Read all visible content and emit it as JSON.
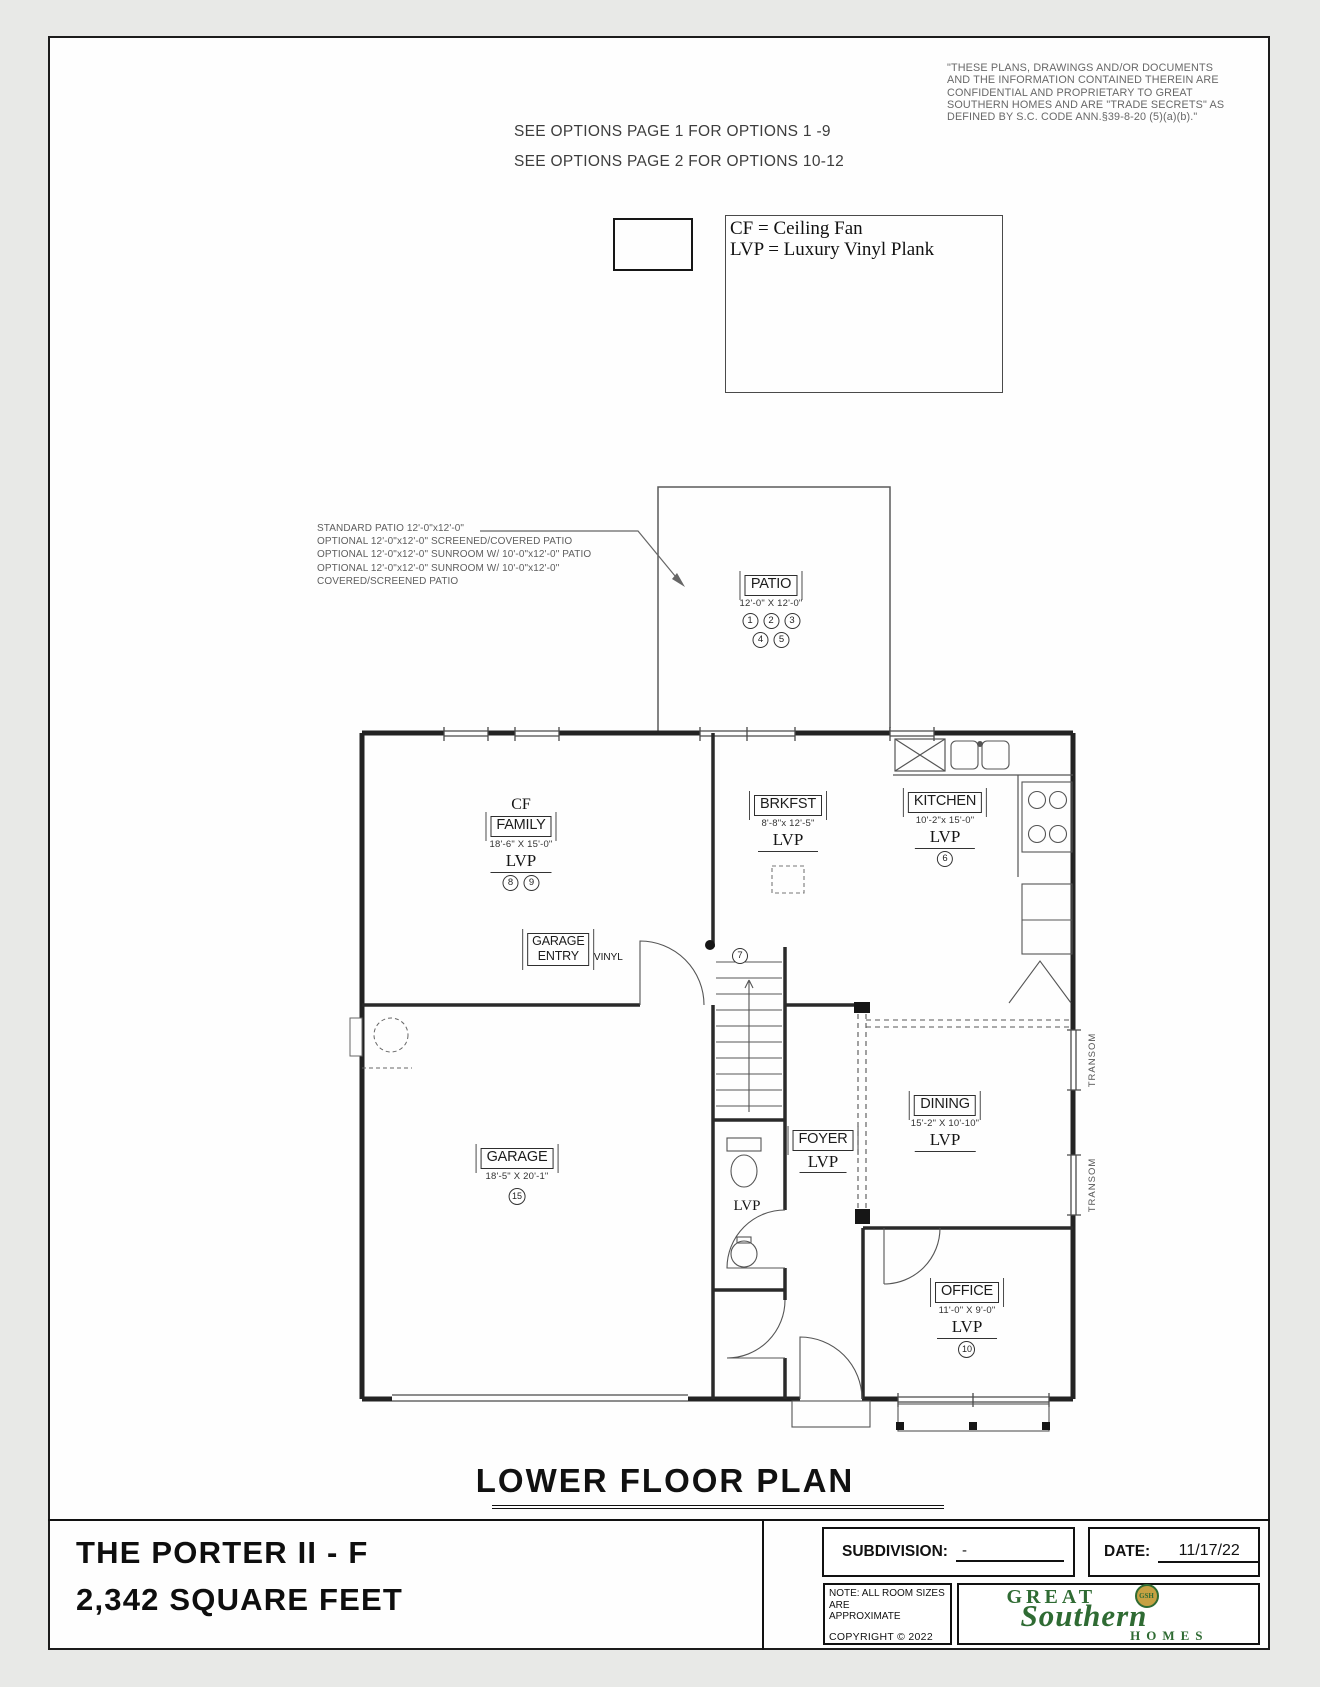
{
  "header": {
    "disclaimer_lines": [
      "\"THESE PLANS, DRAWINGS AND/OR DOCUMENTS",
      "AND THE INFORMATION CONTAINED THEREIN ARE",
      "CONFIDENTIAL AND PROPRIETARY TO  GREAT",
      "SOUTHERN HOMES AND ARE \"TRADE SECRETS\" AS",
      "DEFINED BY S.C. CODE ANN.§39-8-20 (5)(a)(b).\""
    ],
    "options_lines": [
      "SEE OPTIONS PAGE 1 FOR OPTIONS 1 -9",
      "SEE OPTIONS PAGE 2 FOR OPTIONS 10-12"
    ]
  },
  "legend": {
    "lines": [
      "CF = Ceiling Fan",
      "LVP = Luxury Vinyl Plank"
    ]
  },
  "patio_notes": [
    "STANDARD PATIO 12'-0\"x12'-0\"",
    "OPTIONAL 12'-0\"x12'-0\" SCREENED/COVERED PATIO",
    "OPTIONAL 12'-0\"x12'-0\" SUNROOM W/ 10'-0\"x12'-0\" PATIO",
    "OPTIONAL 12'-0\"x12'-0\" SUNROOM W/ 10'-0\"x12'-0\"",
    "COVERED/SCREENED PATIO"
  ],
  "rooms": {
    "patio": {
      "name": "PATIO",
      "dims": "12'-0\" X 12'-0\"",
      "options_row1": [
        "1",
        "2",
        "3"
      ],
      "options_row2": [
        "4",
        "5"
      ]
    },
    "family": {
      "cf": "CF",
      "name": "FAMILY",
      "dims": "18'-6\" X 15'-0\"",
      "floor": "LVP",
      "options": [
        "8",
        "9"
      ]
    },
    "brkfst": {
      "name": "BRKFST",
      "dims": "8'-8\"x 12'-5\"",
      "floor": "LVP"
    },
    "kitchen": {
      "name": "KITCHEN",
      "dims": "10'-2\"x 15'-0\"",
      "floor": "LVP",
      "options": [
        "6"
      ]
    },
    "garage_entry": {
      "name_lines": [
        "GARAGE",
        "ENTRY"
      ],
      "floor": "VINYL",
      "option": "7"
    },
    "dining": {
      "name": "DINING",
      "dims": "15'-2\" X 10'-10\"",
      "floor": "LVP"
    },
    "foyer": {
      "name": "FOYER",
      "floor": "LVP"
    },
    "powder": {
      "floor": "LVP"
    },
    "garage": {
      "name": "GARAGE",
      "dims": "18'-5\" X 20'-1\"",
      "options": [
        "15"
      ]
    },
    "office": {
      "name": "OFFICE",
      "dims": "11'-0\" X 9'-0\"",
      "floor": "LVP",
      "options": [
        "10"
      ]
    },
    "transom_label": "TRANSOM"
  },
  "footer": {
    "plan_title": "LOWER FLOOR PLAN",
    "model_name": "THE PORTER II - F",
    "square_feet": "2,342 SQUARE FEET",
    "subdivision_label": "SUBDIVISION:",
    "subdivision_value": "-",
    "date_label": "DATE:",
    "date_value": "11/17/22",
    "note_lines": [
      "NOTE: ALL ROOM SIZES ARE",
      "APPROXIMATE"
    ],
    "copyright_text": "COPYRIGHT © 2022",
    "logo": {
      "word1": "GREAT",
      "word2": "Southern",
      "word3": "HOMES",
      "monogram": "GSH",
      "green": "#2f6b33",
      "gold": "#c6a143"
    }
  }
}
